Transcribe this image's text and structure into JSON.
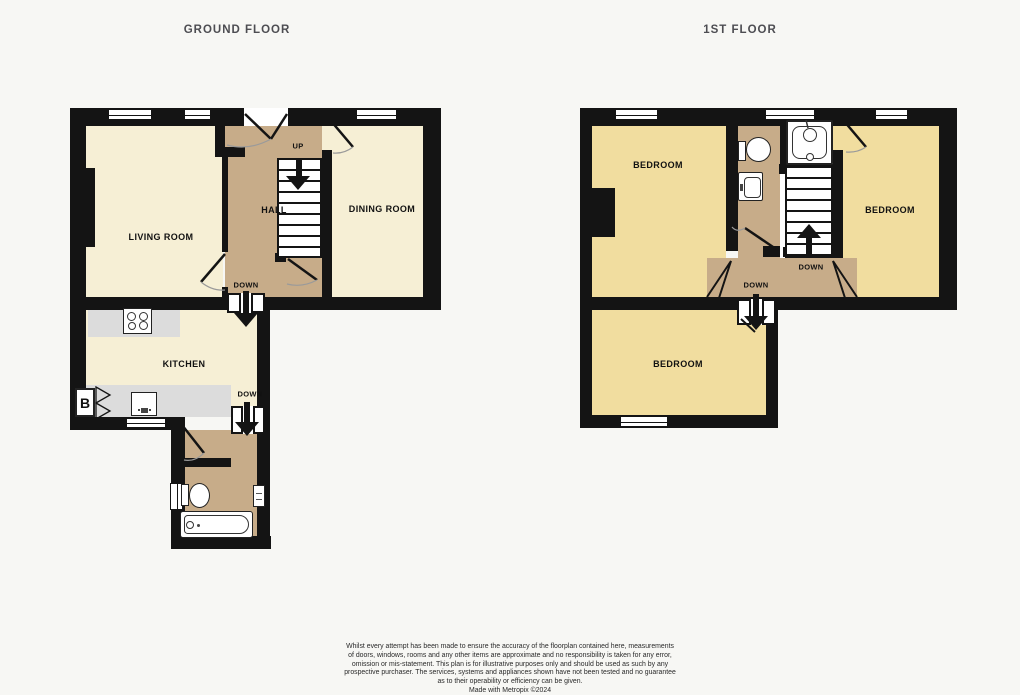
{
  "ground_floor": {
    "title": "GROUND FLOOR",
    "rooms": {
      "living_room": "LIVING ROOM",
      "hall": "HALL",
      "dining_room": "DINING ROOM",
      "kitchen": "KITCHEN"
    },
    "labels": {
      "stairs_up": "UP",
      "hall_down": "DOWN",
      "kitchen_down": "DOWN",
      "boiler": "B"
    },
    "fixtures": [
      "hob-icon",
      "sink-icon",
      "boiler-cupboard-icon",
      "toilet-icon",
      "bath-icon",
      "radiator-icon"
    ]
  },
  "first_floor": {
    "title": "1ST FLOOR",
    "rooms": {
      "bedroom_left": "BEDROOM",
      "bedroom_right": "BEDROOM",
      "bedroom_lower": "BEDROOM"
    },
    "labels": {
      "stairs_down": "DOWN",
      "landing_down": "DOWN"
    },
    "fixtures": [
      "toilet-icon",
      "basin-icon",
      "shower-icon"
    ]
  },
  "colors": {
    "wall": "#141414",
    "room_cream": "#f6efd5",
    "hall_tan": "#c7ac89",
    "bedroom_yellow": "#f1dd9f",
    "worktop_gray": "#dcdcdc",
    "background": "#f7f7f4",
    "title_text": "#4d4d52"
  },
  "footer": {
    "lines": [
      "Whilst every attempt has been made to ensure the accuracy of the floorplan contained here, measurements",
      "of doors, windows, rooms and any other items are approximate and no responsibility is taken for any error,",
      "omission or mis-statement. This plan is for illustrative purposes only and should be used as such by any",
      "prospective purchaser. The services, systems and appliances shown have not been tested and no guarantee",
      "as to their operability or efficiency can be given."
    ],
    "credit": "Made with Metropix ©2024"
  }
}
